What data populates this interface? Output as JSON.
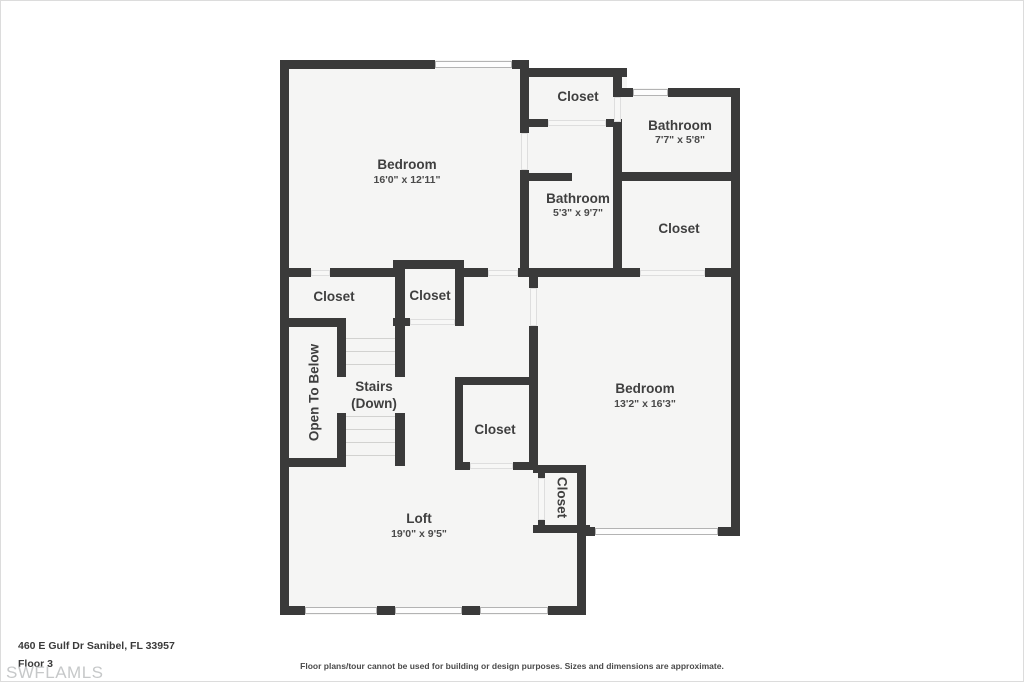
{
  "plan": {
    "rooms": {
      "bedroom_1": {
        "label": "Bedroom",
        "dims": "16'0\" x 12'11\""
      },
      "closet_top": {
        "label": "Closet"
      },
      "bathroom_top": {
        "label": "Bathroom",
        "dims": "7'7\" x 5'8\""
      },
      "bathroom_mid": {
        "label": "Bathroom",
        "dims": "5'3\" x 9'7\""
      },
      "closet_right": {
        "label": "Closet"
      },
      "closet_left": {
        "label": "Closet"
      },
      "closet_hall": {
        "label": "Closet"
      },
      "open_to_below": {
        "label": "Open To Below"
      },
      "stairs": {
        "line1": "Stairs",
        "line2": "(Down)"
      },
      "bedroom_2": {
        "label": "Bedroom",
        "dims": "13'2\" x 16'3\""
      },
      "closet_mid": {
        "label": "Closet"
      },
      "closet_loft": {
        "label": "Closet"
      },
      "loft": {
        "label": "Loft",
        "dims": "19'0\" x 9'5\""
      }
    },
    "colors": {
      "wall": "#3a3a3a",
      "floor": "#f5f5f4",
      "text": "#3f3f3f",
      "watermark": "#c6c8c9"
    }
  },
  "footer": {
    "address": "460 E Gulf Dr Sanibel, FL 33957",
    "floor_label": "Floor 3",
    "watermark": "SWFLAMLS",
    "disclaimer": "Floor plans/tour cannot be used for building or design purposes. Sizes and dimensions are approximate."
  }
}
